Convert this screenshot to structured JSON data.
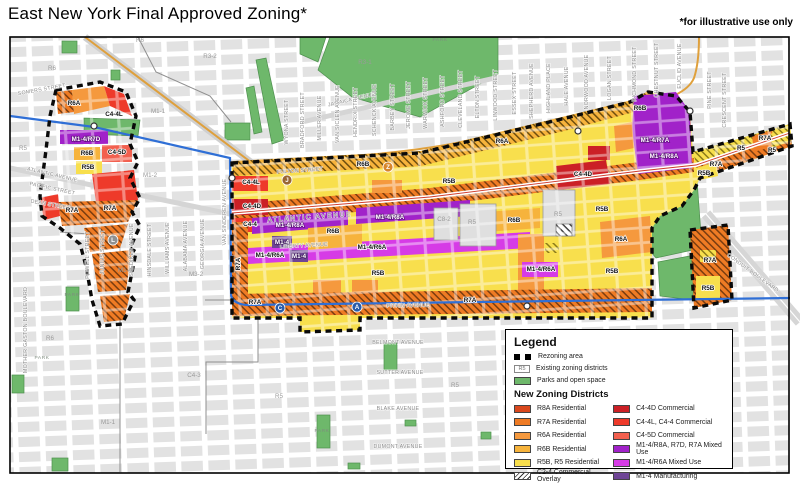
{
  "title": "East New York Final Approved Zoning*",
  "note": "*for illustrative use only",
  "colors": {
    "r8a": "#D9481D",
    "r7a": "#EF7B24",
    "r6a": "#F5993E",
    "r6b": "#F6B33C",
    "r5b": "#F8DF4D",
    "c44d": "#CB2026",
    "c44": "#EE3A2A",
    "c45d": "#F2604F",
    "m14r8a": "#A122C9",
    "m14r6a": "#D63BE6",
    "m14": "#6E4595",
    "park": "#6EB86B",
    "parkStroke": "#4E8F4E",
    "block": "#E2E2E2",
    "subwayBlue": "#2F6FD6",
    "roadOrange": "#DFA03C",
    "boundary": "#000000"
  },
  "legend": {
    "title": "Legend",
    "rezoning_label": "Rezoning area",
    "existing_symbol": "R5",
    "existing_label": "Existing zoning districts",
    "parks_label": "Parks and open space",
    "districts_title": "New Zoning Districts",
    "left": [
      {
        "label": "R8A Residential"
      },
      {
        "label": "R7A Residential"
      },
      {
        "label": "R6A Residential"
      },
      {
        "label": "R6B Residential"
      },
      {
        "label": "R5B, R5 Residential"
      },
      {
        "label": "C2-4 Commercial Overlay"
      }
    ],
    "right": [
      {
        "label": "C4-4D Commercial"
      },
      {
        "label": "C4-4L, C4-4 Commercial"
      },
      {
        "label": "C4-5D Commercial"
      },
      {
        "label": "M1-4/R8A, R7D, R7A Mixed Use"
      },
      {
        "label": "M1-4/R6A Mixed Use"
      },
      {
        "label": "M1-4 Manufacturing"
      }
    ]
  },
  "map": {
    "streets": [
      {
        "t": "SOMERS STREET",
        "x": 42,
        "y": 91,
        "r": -10
      },
      {
        "t": "ATLANTIC AVENUE",
        "x": 52,
        "y": 176,
        "r": 13
      },
      {
        "t": "PACIFIC STREET",
        "x": 52,
        "y": 190,
        "r": 12
      },
      {
        "t": "DEAN STREET",
        "x": 50,
        "y": 206,
        "r": 10
      },
      {
        "t": "ATLANTIC AVENUE",
        "x": 310,
        "y": 219,
        "r": -4,
        "big": 1
      },
      {
        "t": "FULTON STREET",
        "x": 300,
        "y": 172,
        "r": -4
      },
      {
        "t": "LIBERTY AVENUE",
        "x": 304,
        "y": 247,
        "r": -3
      },
      {
        "t": "PITKIN AVENUE",
        "x": 408,
        "y": 307,
        "r": -1
      },
      {
        "t": "JAMAICA AVENUE",
        "x": 352,
        "y": 101,
        "r": -13
      },
      {
        "t": "BELMONT AVENUE",
        "x": 398,
        "y": 344
      },
      {
        "t": "SUTTER AVENUE",
        "x": 400,
        "y": 374
      },
      {
        "t": "BLAKE AVENUE",
        "x": 398,
        "y": 410
      },
      {
        "t": "DUMONT AVENUE",
        "x": 398,
        "y": 448
      },
      {
        "t": "CONDUIT BOULEVARD",
        "x": 752,
        "y": 274,
        "r": 36
      },
      {
        "t": "MOTHER GASTON BOULEVARD",
        "x": 27,
        "y": 330,
        "r": -90
      },
      {
        "t": "POWELL STREET",
        "x": 89,
        "y": 255,
        "r": -90
      },
      {
        "t": "JUNIUS STREET",
        "x": 104,
        "y": 252,
        "r": -90
      },
      {
        "t": "SNEDIKER AVENUE",
        "x": 133,
        "y": 250,
        "r": -90
      },
      {
        "t": "HINSDALE STREET",
        "x": 151,
        "y": 250,
        "r": -90
      },
      {
        "t": "WILLIAMS AVENUE",
        "x": 169,
        "y": 248,
        "r": -90
      },
      {
        "t": "ALABAMA AVENUE",
        "x": 187,
        "y": 246,
        "r": -90
      },
      {
        "t": "GEORGIA AVENUE",
        "x": 204,
        "y": 244,
        "r": -90
      },
      {
        "t": "VAN SINDEREN AVENUE",
        "x": 226,
        "y": 212,
        "r": -90
      },
      {
        "t": "WYONA STREET",
        "x": 288,
        "y": 122,
        "r": -90
      },
      {
        "t": "BRADFORD STREET",
        "x": 304,
        "y": 120,
        "r": -90
      },
      {
        "t": "MILLER AVENUE",
        "x": 321,
        "y": 118,
        "r": -90
      },
      {
        "t": "VAN SICLEN AVENUE",
        "x": 339,
        "y": 114,
        "r": -90
      },
      {
        "t": "HENDRIX STREET",
        "x": 357,
        "y": 112,
        "r": -90
      },
      {
        "t": "SCHENCK AVENUE",
        "x": 376,
        "y": 110,
        "r": -90
      },
      {
        "t": "BARBEY STREET",
        "x": 394,
        "y": 107,
        "r": -90
      },
      {
        "t": "JEROME STREET",
        "x": 410,
        "y": 105,
        "r": -90
      },
      {
        "t": "WARWICK STREET",
        "x": 427,
        "y": 103,
        "r": -90
      },
      {
        "t": "ASHFORD STREET",
        "x": 444,
        "y": 101,
        "r": -90
      },
      {
        "t": "CLEVELAND STREET",
        "x": 462,
        "y": 99,
        "r": -90
      },
      {
        "t": "ELTON STREET",
        "x": 479,
        "y": 97,
        "r": -90
      },
      {
        "t": "LINWOOD STREET",
        "x": 497,
        "y": 95,
        "r": -90
      },
      {
        "t": "ESSEX STREET",
        "x": 516,
        "y": 93,
        "r": -90
      },
      {
        "t": "SHEPHERD AVENUE",
        "x": 533,
        "y": 91,
        "r": -90
      },
      {
        "t": "HIGHLAND PLACE",
        "x": 550,
        "y": 88,
        "r": -90
      },
      {
        "t": "HALE AVENUE",
        "x": 568,
        "y": 86,
        "r": -90
      },
      {
        "t": "NORWOOD AVENUE",
        "x": 588,
        "y": 82,
        "r": -90
      },
      {
        "t": "LOGAN STREET",
        "x": 611,
        "y": 78,
        "r": -90
      },
      {
        "t": "RICHMOND STREET",
        "x": 636,
        "y": 74,
        "r": -90
      },
      {
        "t": "CHESTNUT STREET",
        "x": 658,
        "y": 70,
        "r": -90
      },
      {
        "t": "EUCLID AVENUE",
        "x": 681,
        "y": 66,
        "r": -90
      },
      {
        "t": "PINE STREET",
        "x": 711,
        "y": 90,
        "r": -90
      },
      {
        "t": "CRESCENT STREET",
        "x": 726,
        "y": 100,
        "r": -90
      }
    ],
    "zones": [
      {
        "t": "R6A",
        "x": 74,
        "y": 105
      },
      {
        "t": "C4-4L",
        "x": 114,
        "y": 116
      },
      {
        "t": "M1-4/R7D",
        "x": 86,
        "y": 141,
        "c": "w"
      },
      {
        "t": "R6B",
        "x": 87,
        "y": 155
      },
      {
        "t": "C4-5D",
        "x": 117,
        "y": 154
      },
      {
        "t": "R5B",
        "x": 88,
        "y": 169
      },
      {
        "t": "R7A",
        "x": 72,
        "y": 212
      },
      {
        "t": "R7A",
        "x": 110,
        "y": 210
      },
      {
        "t": "C4-4L",
        "x": 251,
        "y": 184
      },
      {
        "t": "C4-4D",
        "x": 252,
        "y": 208
      },
      {
        "t": "C4-4",
        "x": 250,
        "y": 226
      },
      {
        "t": "R6B",
        "x": 363,
        "y": 166
      },
      {
        "t": "R6A",
        "x": 502,
        "y": 143
      },
      {
        "t": "R6B",
        "x": 640,
        "y": 110
      },
      {
        "t": "M1-4/R8A",
        "x": 290,
        "y": 227,
        "c": "w"
      },
      {
        "t": "M1-4/R8A",
        "x": 390,
        "y": 219,
        "c": "w"
      },
      {
        "t": "M1-4",
        "x": 282,
        "y": 244,
        "c": "w"
      },
      {
        "t": "M1-4",
        "x": 299,
        "y": 258,
        "c": "w"
      },
      {
        "t": "M1-4/R6A",
        "x": 270,
        "y": 257
      },
      {
        "t": "M1-4/R6A",
        "x": 372,
        "y": 249
      },
      {
        "t": "M1-4/R6A",
        "x": 541,
        "y": 271
      },
      {
        "t": "C4-4D",
        "x": 583,
        "y": 176
      },
      {
        "t": "R6B",
        "x": 333,
        "y": 233
      },
      {
        "t": "R6B",
        "x": 514,
        "y": 222
      },
      {
        "t": "R5B",
        "x": 449,
        "y": 183
      },
      {
        "t": "R5B",
        "x": 378,
        "y": 275
      },
      {
        "t": "R5B",
        "x": 612,
        "y": 273
      },
      {
        "t": "R5B",
        "x": 602,
        "y": 211
      },
      {
        "t": "R6A",
        "x": 621,
        "y": 241
      },
      {
        "t": "R7A",
        "x": 240,
        "y": 264,
        "r": -90
      },
      {
        "t": "R7A",
        "x": 255,
        "y": 304
      },
      {
        "t": "R7A",
        "x": 470,
        "y": 302
      },
      {
        "t": "R5",
        "x": 741,
        "y": 150
      },
      {
        "t": "R7A",
        "x": 716,
        "y": 166
      },
      {
        "t": "R5B",
        "x": 704,
        "y": 175
      },
      {
        "t": "R7A",
        "x": 765,
        "y": 140
      },
      {
        "t": "R5",
        "x": 772,
        "y": 152
      },
      {
        "t": "R7A",
        "x": 710,
        "y": 262
      },
      {
        "t": "R5B",
        "x": 708,
        "y": 290
      },
      {
        "t": "M1-4/R7A",
        "x": 655,
        "y": 142,
        "c": "w"
      },
      {
        "t": "M1-4/R8A",
        "x": 664,
        "y": 158,
        "c": "w"
      }
    ],
    "existing": [
      {
        "t": "R5",
        "x": 23,
        "y": 150
      },
      {
        "t": "R6",
        "x": 52,
        "y": 70
      },
      {
        "t": "R6",
        "x": 140,
        "y": 42
      },
      {
        "t": "R3-2",
        "x": 210,
        "y": 58
      },
      {
        "t": "R3-1",
        "x": 365,
        "y": 64
      },
      {
        "t": "M1-1",
        "x": 158,
        "y": 113
      },
      {
        "t": "M1-2",
        "x": 150,
        "y": 177
      },
      {
        "t": "M1-4",
        "x": 125,
        "y": 272
      },
      {
        "t": "M3-2",
        "x": 196,
        "y": 276
      },
      {
        "t": "R6",
        "x": 50,
        "y": 340
      },
      {
        "t": "M1-1",
        "x": 108,
        "y": 424
      },
      {
        "t": "C4-3",
        "x": 194,
        "y": 377
      },
      {
        "t": "R5",
        "x": 279,
        "y": 398
      },
      {
        "t": "R5",
        "x": 455,
        "y": 387
      },
      {
        "t": "R5",
        "x": 472,
        "y": 224
      },
      {
        "t": "R5",
        "x": 558,
        "y": 216
      },
      {
        "t": "C8-2",
        "x": 444,
        "y": 221
      }
    ],
    "park_labels": [
      {
        "t": "PARK",
        "x": 440,
        "y": 41
      },
      {
        "t": "PARK",
        "x": 72,
        "y": 296
      },
      {
        "t": "PARK",
        "x": 42,
        "y": 359
      },
      {
        "t": "PARK",
        "x": 322,
        "y": 432
      }
    ],
    "badges": [
      {
        "t": "J",
        "x": 287,
        "y": 180,
        "bg": "#996633"
      },
      {
        "t": "Z",
        "x": 388,
        "y": 167,
        "bg": "#D7862C"
      },
      {
        "t": "C",
        "x": 280,
        "y": 308,
        "bg": "#2A5CAA"
      },
      {
        "t": "A",
        "x": 357,
        "y": 307,
        "bg": "#2A5CAA"
      },
      {
        "t": "L",
        "x": 113,
        "y": 240,
        "bg": "#8E9091"
      }
    ],
    "stations": [
      {
        "x": 94,
        "y": 126
      },
      {
        "x": 232,
        "y": 178
      },
      {
        "x": 578,
        "y": 131
      },
      {
        "x": 690,
        "y": 111
      },
      {
        "x": 527,
        "y": 306
      }
    ]
  }
}
